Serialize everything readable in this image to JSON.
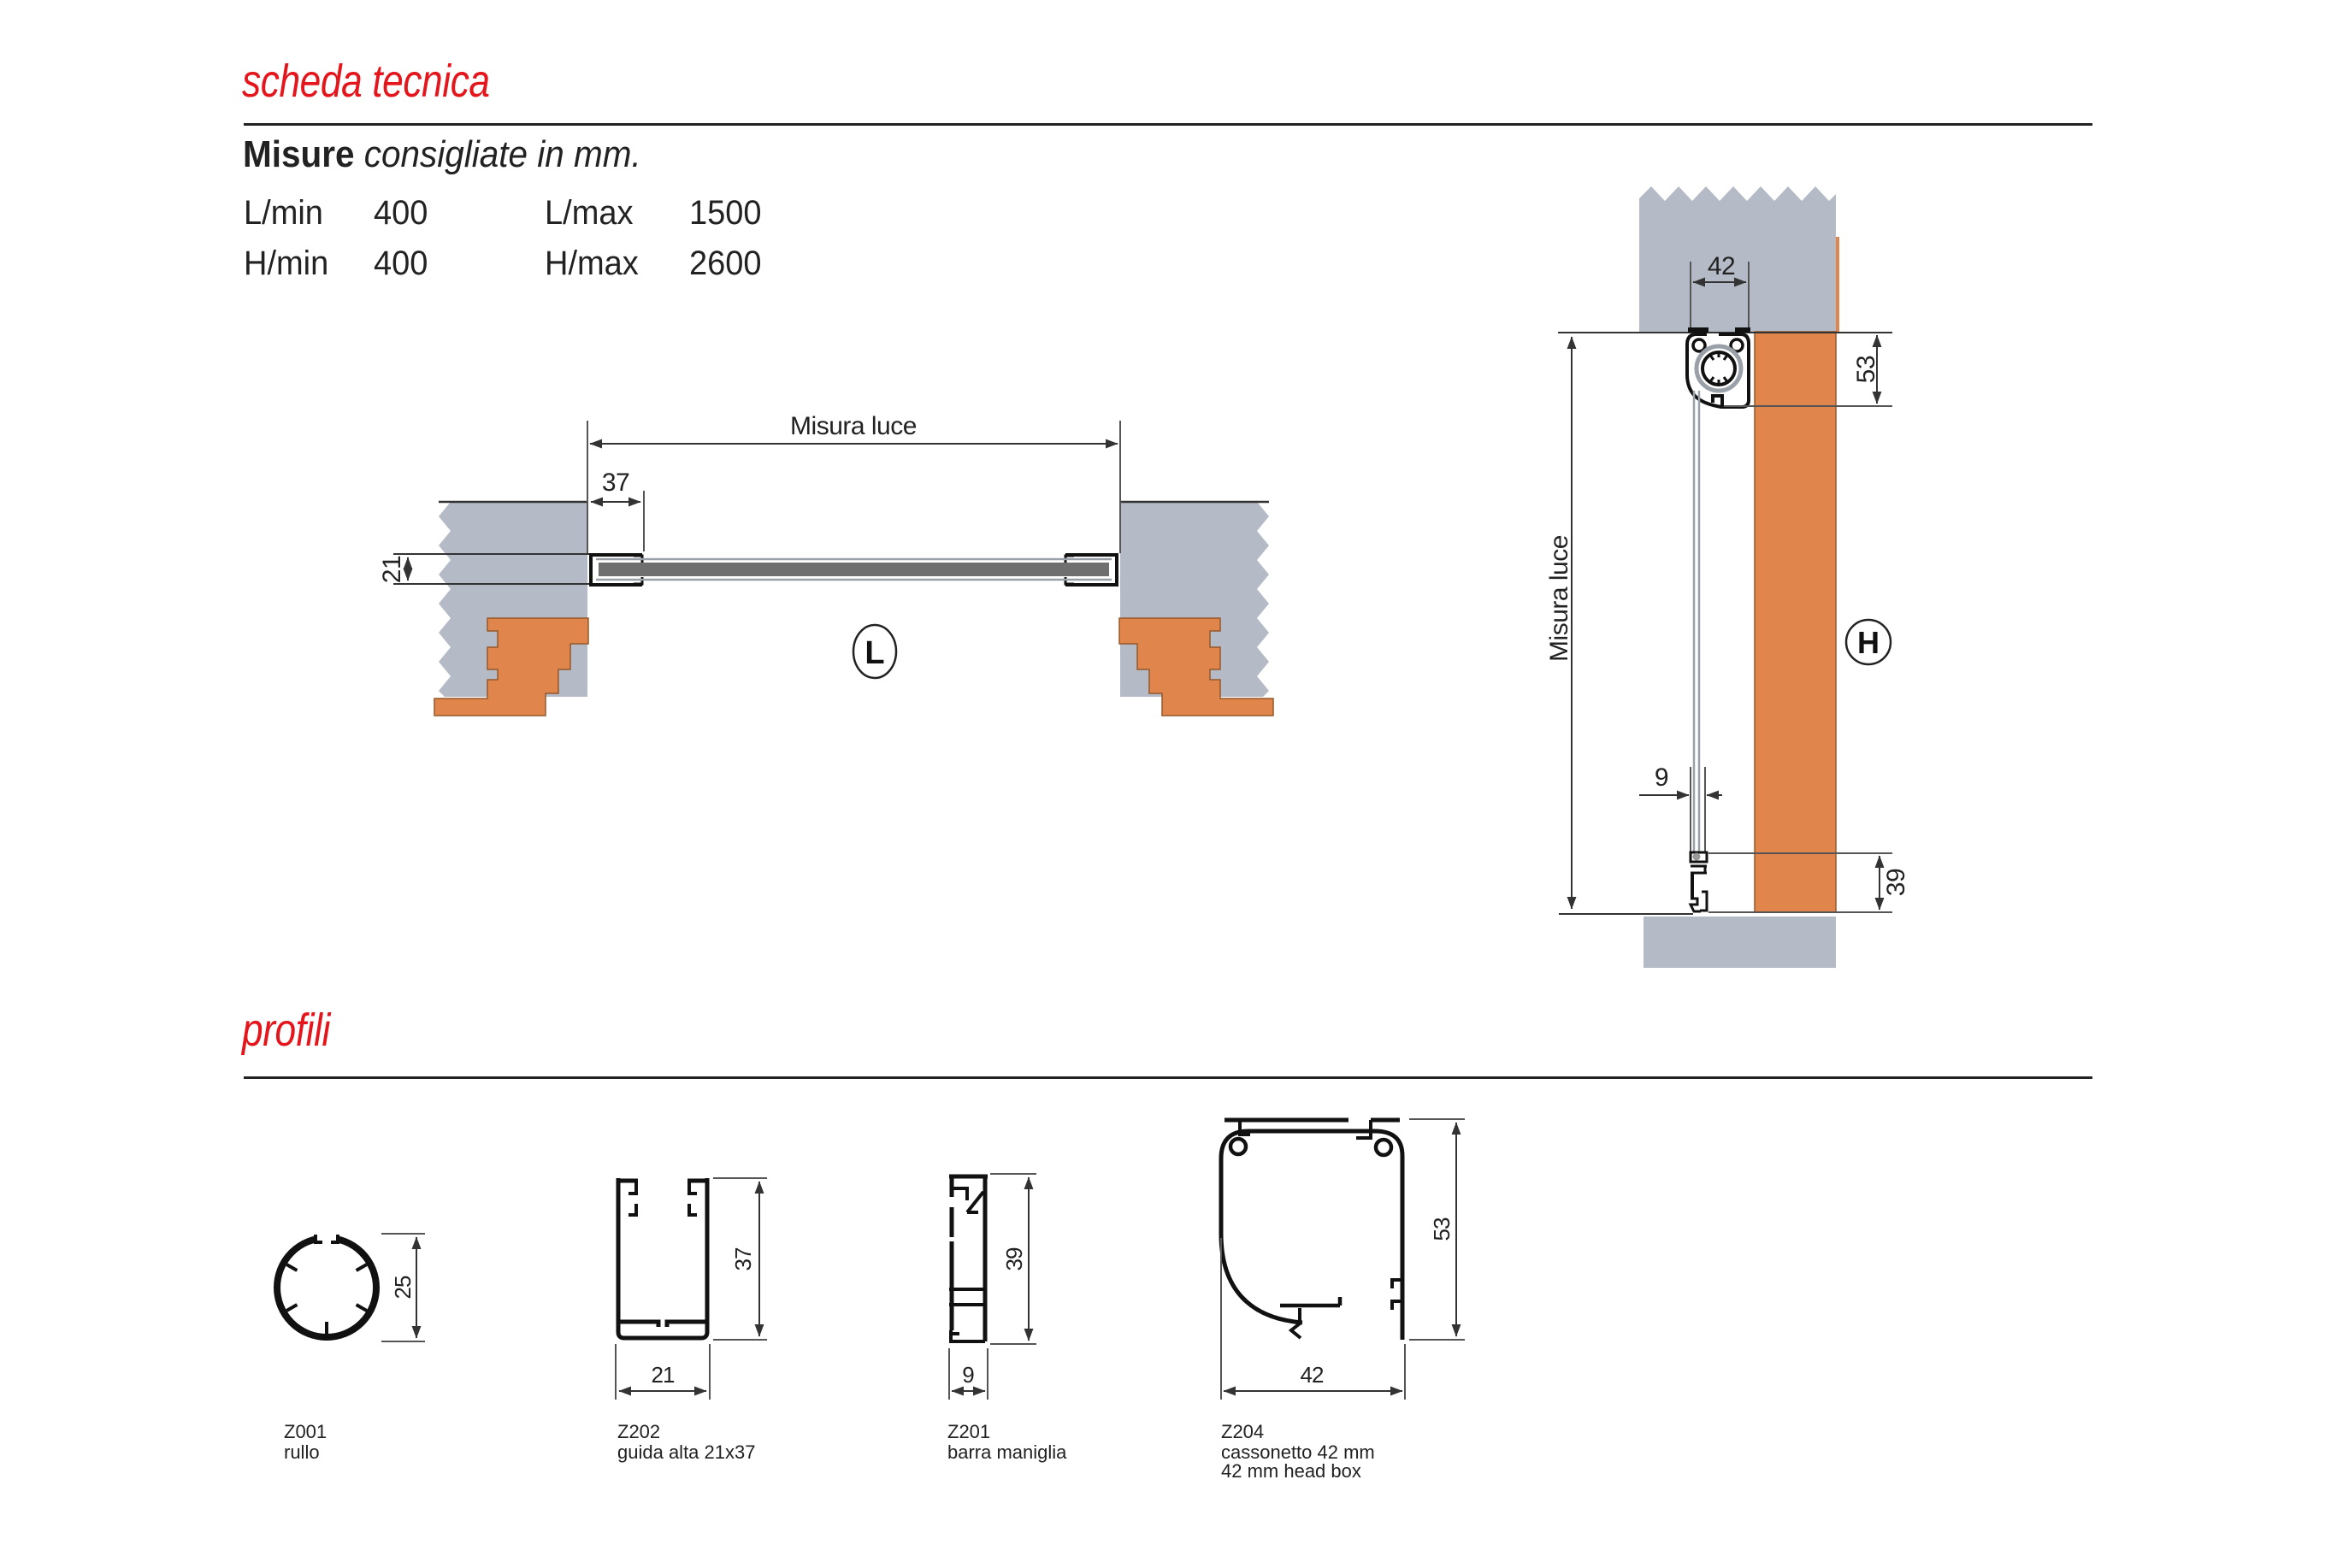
{
  "colors": {
    "accent_red": "#e4151b",
    "wall_gray": "#b5bbc6",
    "brick_orange": "#e0854c",
    "mesh_dark": "#6f6f6f",
    "line_dark": "#333333",
    "line_light": "#9aa0a8"
  },
  "header": {
    "title": "scheda tecnica"
  },
  "misure": {
    "heading_bold": "Misure",
    "heading_italic": "consigliate in mm.",
    "rows": [
      [
        "L/min",
        "400",
        "L/max",
        "1500"
      ],
      [
        "H/min",
        "400",
        "H/max",
        "2600"
      ]
    ]
  },
  "drawing_l": {
    "misura_luce": "Misura luce",
    "dim_offset": "37",
    "dim_height": "21",
    "badge": "L"
  },
  "drawing_h": {
    "dim_box_width": "42",
    "dim_box_height": "53",
    "misura_luce": "Misura luce",
    "dim_bar_width": "9",
    "dim_bar_height": "39",
    "badge": "H"
  },
  "profili": {
    "heading": "profili",
    "items": [
      {
        "code": "Z001",
        "name": "rullo",
        "dim1": "25"
      },
      {
        "code": "Z202",
        "name": "guida alta 21x37",
        "dim1": "37",
        "dim2": "21"
      },
      {
        "code": "Z201",
        "name": "barra maniglia",
        "dim1": "39",
        "dim2": "9"
      },
      {
        "code": "Z204",
        "name": "cassonetto 42 mm",
        "name2": "42 mm head box",
        "dim1": "53",
        "dim2": "42"
      }
    ]
  }
}
